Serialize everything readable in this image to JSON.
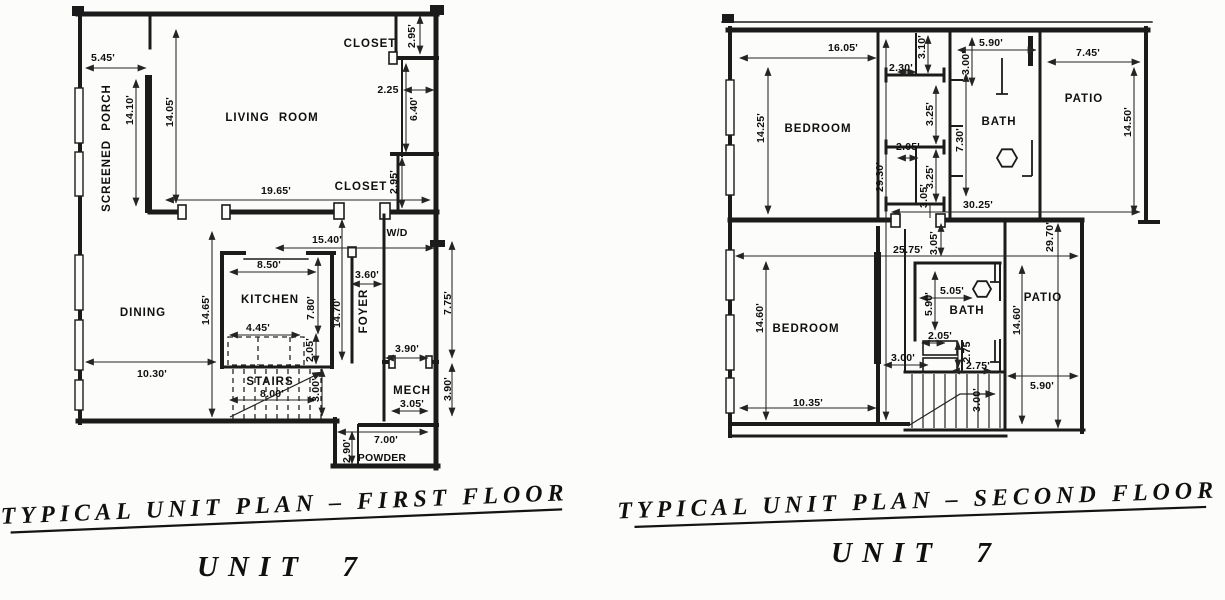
{
  "first": {
    "caption": "TYPICAL UNIT PLAN – FIRST FLOOR",
    "unit": "UNIT  7",
    "rooms": {
      "screened_porch": "SCREENED PORCH",
      "living": "LIVING ROOM",
      "closet_top": "CLOSET",
      "closet_bottom": "CLOSET",
      "wd": "W/D",
      "dining": "DINING",
      "kitchen": "KITCHEN",
      "foyer": "FOYER",
      "stairs": "STAIRS",
      "mech": "MECH",
      "powder": "POWDER"
    },
    "dims": {
      "porch_w": "5.45'",
      "porch_h": "14.10'",
      "living_h": "14.05'",
      "closet_top_d": "2.95'",
      "nook_w": "2.25",
      "nook_h": "6.40'",
      "living_w": "19.65'",
      "closet_bot_d": "2.95'",
      "hall_w": "15.40'",
      "foyer_w": "3.60'",
      "kitchen_w": "8.50'",
      "kitchen_h": "7.80'",
      "foyer_h": "14.70'",
      "dining_h": "14.65'",
      "counter_w": "4.45'",
      "counter_d": "2.05'",
      "dining_w": "10.30'",
      "stair_w": "8.00'",
      "stair_d": "3.00'",
      "right_upper": "7.75'",
      "mech_door": "3.90'",
      "right_lower": "3.90'",
      "mech_w": "3.05'",
      "powder_d": "2.90'",
      "powder_w": "7.00'"
    }
  },
  "second": {
    "caption": "TYPICAL UNIT PLAN – SECOND FLOOR",
    "unit": "UNIT  7",
    "rooms": {
      "bedroom_top": "BEDROOM",
      "bath_top": "BATH",
      "patio_top": "PATIO",
      "bedroom_bottom": "BEDROOM",
      "bath_bottom": "BATH",
      "patio_bottom": "PATIO"
    },
    "dims": {
      "bed1_w": "16.05'",
      "c230": "2.30'",
      "c310": "3.10'",
      "bath1_w": "5.90'",
      "bath1_d": "3.00'",
      "patio1_w": "7.45'",
      "patio1_h": "14.50'",
      "bed1_h": "14.25'",
      "c325_u": "3.25'",
      "c205_u": "2.05'",
      "c325_l": "3.25'",
      "bath1_h": "7.30'",
      "total_h": "29.30'",
      "c305_u": "3.05'",
      "upper_w": "30.25'",
      "mid_w": "25.75'",
      "c305_m": "3.05'",
      "right_h": "29.70'",
      "bath2_w": "5.05'",
      "bath2_h": "5.90'",
      "c205_l": "2.05'",
      "c275_v": "2.75",
      "c275_h": "2.75'",
      "hall_w": "3.00'",
      "bed2_h": "14.60'",
      "bed2_w": "10.35'",
      "patio2_h": "14.60'",
      "stair_v": "3.00'",
      "patio2_w": "5.90'"
    }
  }
}
